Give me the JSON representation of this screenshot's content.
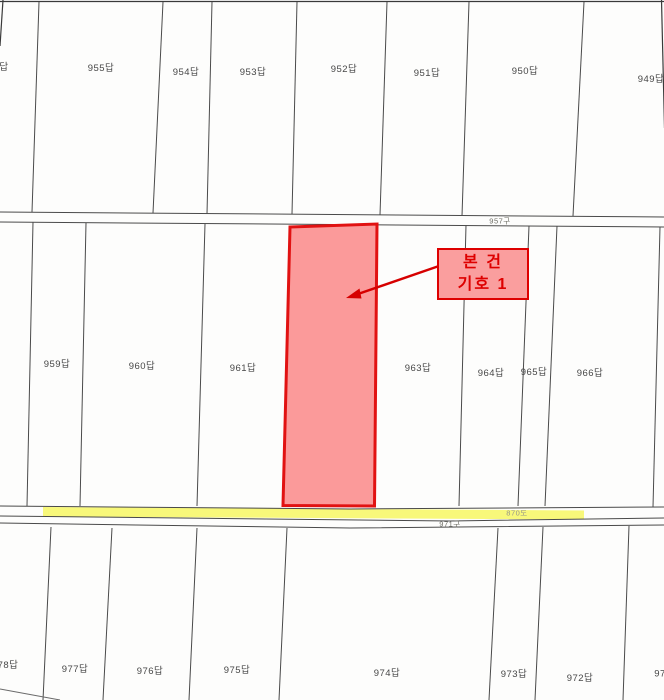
{
  "annotation": {
    "line1": "본 건",
    "line2": "기호 1"
  },
  "labels": {
    "waterway_top": "957구",
    "road": "870도",
    "waterway_bottom": "971구"
  },
  "parcels_top": [
    {
      "label": "답"
    },
    {
      "label": "955답"
    },
    {
      "label": "954답"
    },
    {
      "label": "953답"
    },
    {
      "label": "952답"
    },
    {
      "label": "951답"
    },
    {
      "label": "950답"
    },
    {
      "label": "949답"
    }
  ],
  "parcels_middle": [
    {
      "label": "959답"
    },
    {
      "label": "960답"
    },
    {
      "label": "961답"
    },
    {
      "label": "963답"
    },
    {
      "label": "964답"
    },
    {
      "label": "965답"
    },
    {
      "label": "966답"
    }
  ],
  "parcels_bottom": [
    {
      "label": "78답"
    },
    {
      "label": "977답"
    },
    {
      "label": "976답"
    },
    {
      "label": "975답"
    },
    {
      "label": "974답"
    },
    {
      "label": "973답"
    },
    {
      "label": "972답"
    },
    {
      "label": "97"
    }
  ],
  "colors": {
    "highlight_parcel_fill": "#FB9A9A",
    "highlight_parcel_border": "#E11212",
    "road_highlight_fill": "#F8F87A",
    "annotation_text": "#DE0000",
    "boundary_line": "#4A4A4A"
  }
}
